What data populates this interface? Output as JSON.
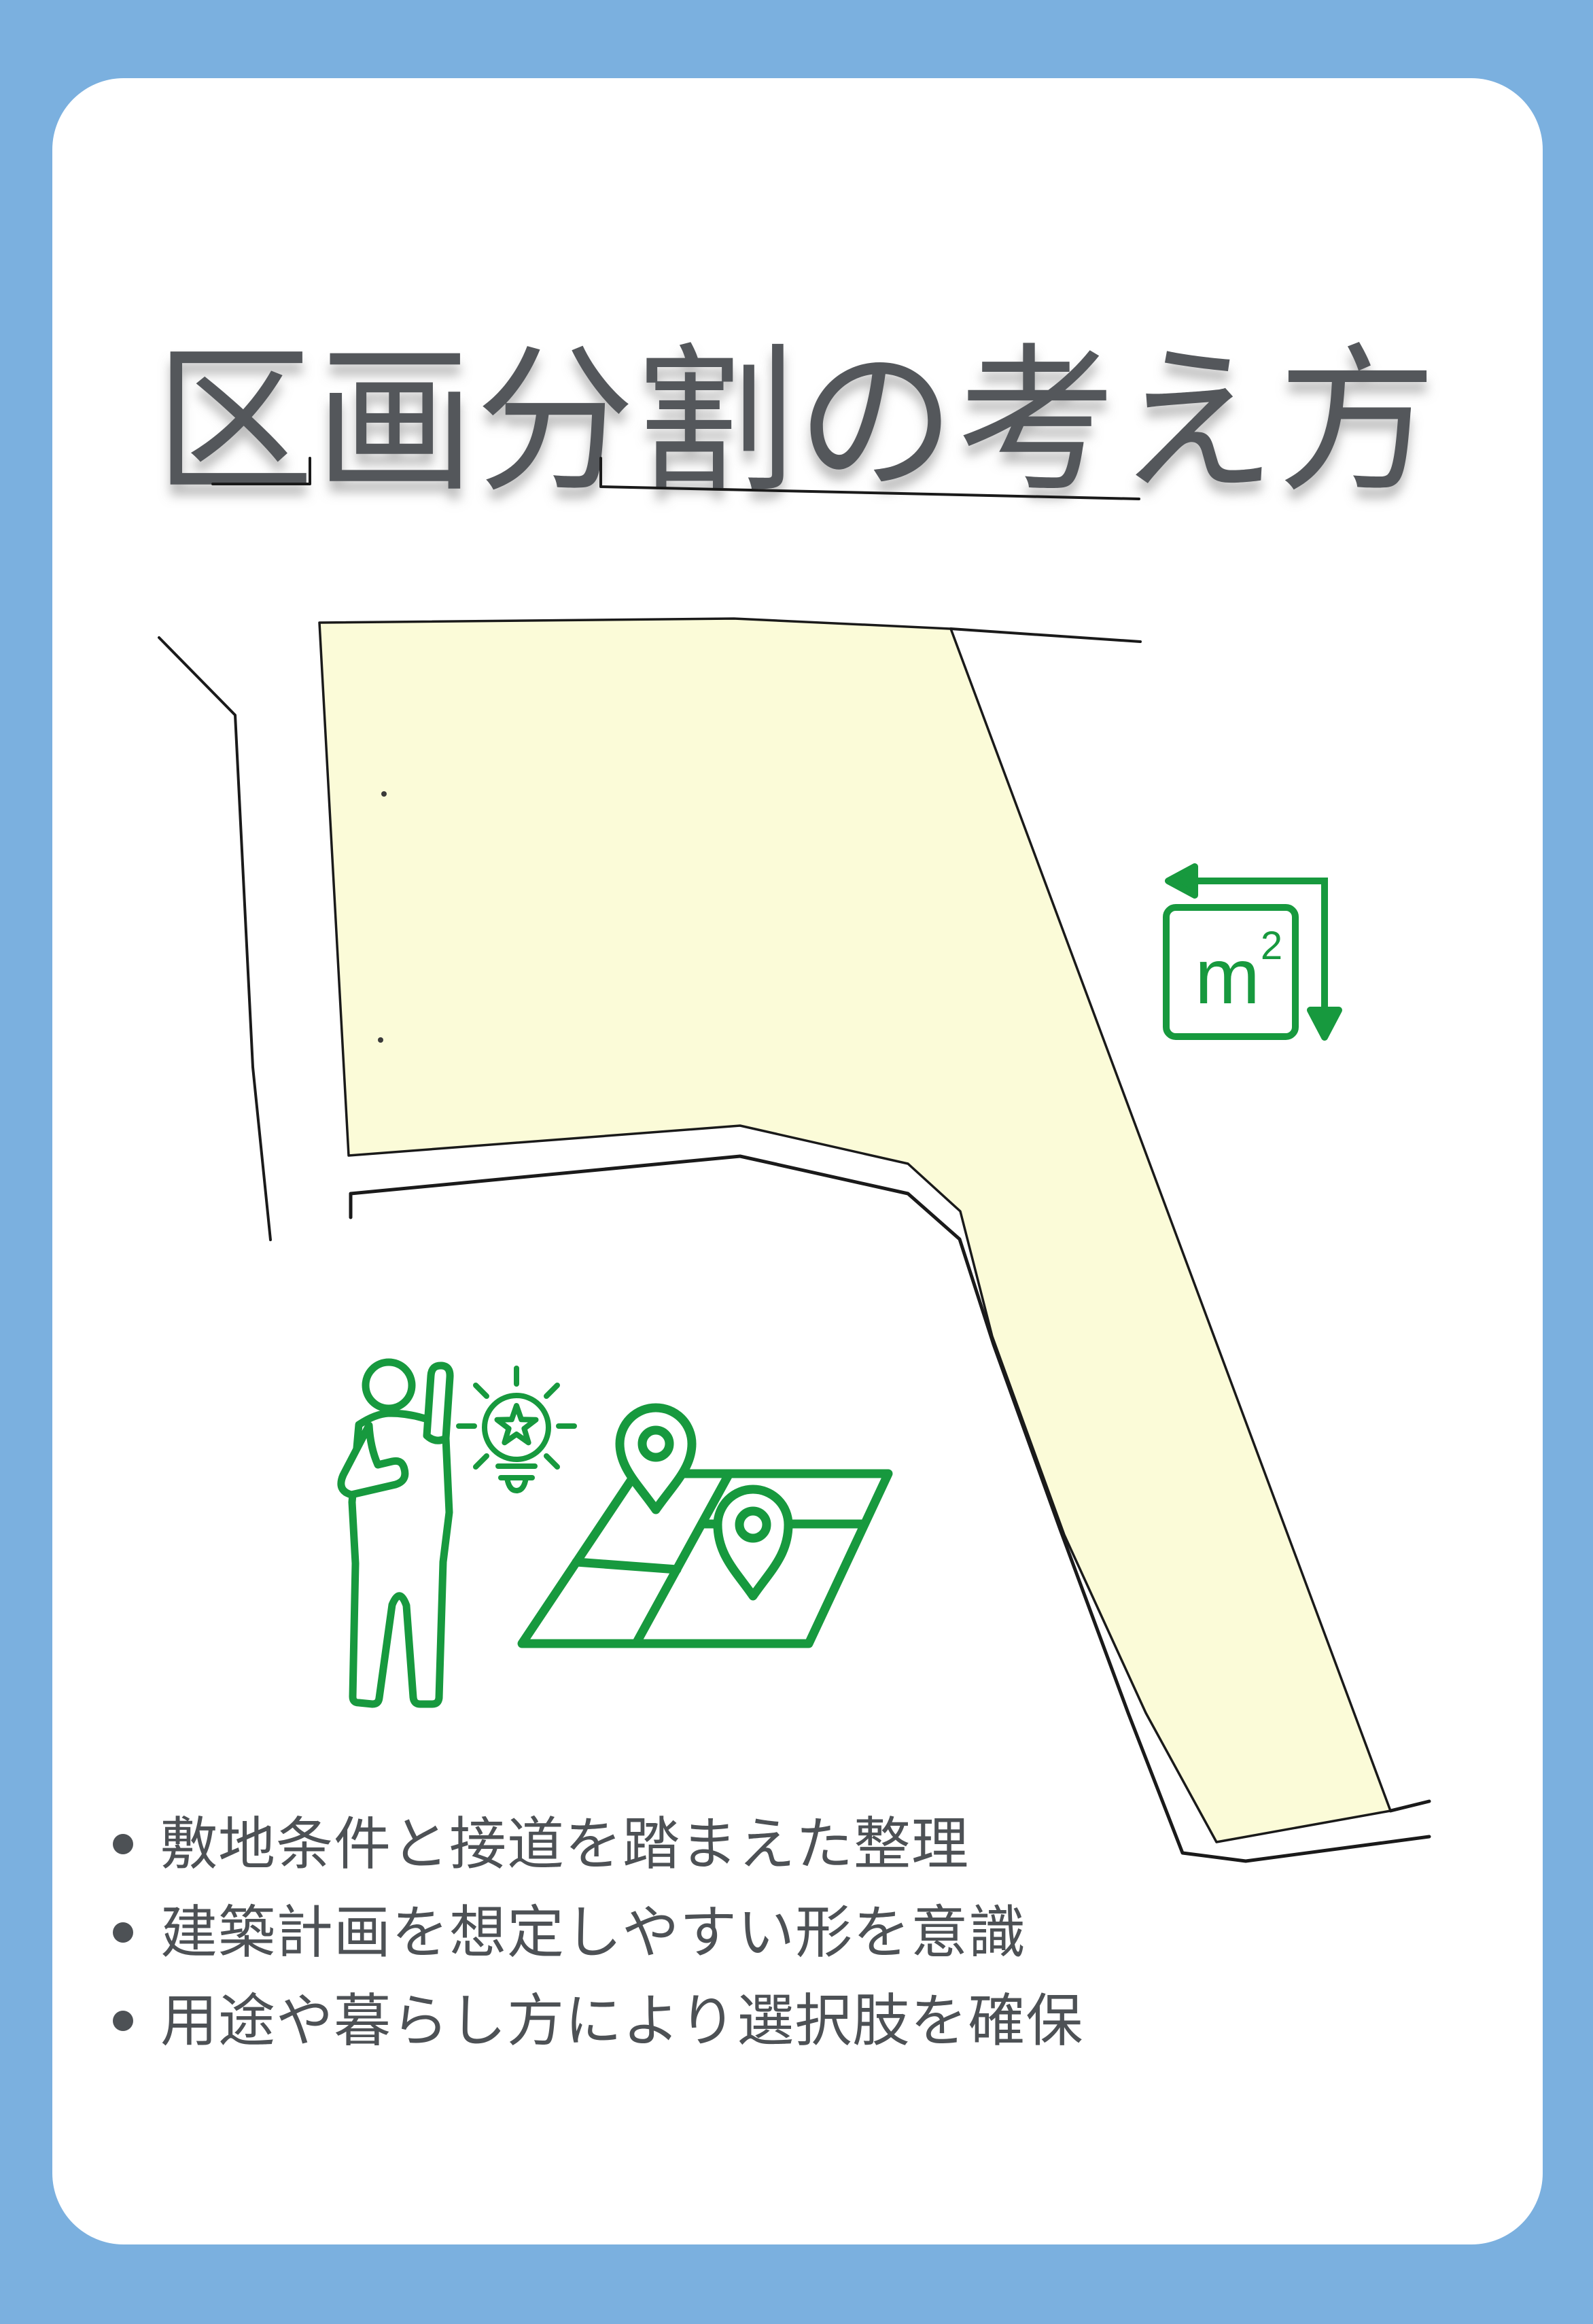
{
  "title": "区画分割の考え方",
  "bullets": [
    "敷地条件と接道を踏まえた整理",
    "建築計画を想定しやすい形を意識",
    "用途や暮らし方により選択肢を確保"
  ],
  "m2_icon": {
    "base": "m",
    "sup": "2"
  },
  "icons": [
    {
      "name": "area-measure-icon",
      "meaning": "m2 square with width/height arrows"
    },
    {
      "name": "person-presenting-icon",
      "meaning": "person raising hand"
    },
    {
      "name": "lightbulb-star-icon",
      "meaning": "idea bulb with star"
    },
    {
      "name": "map-pins-icon",
      "meaning": "folded map with two location pins"
    }
  ],
  "colors": {
    "background_blue": "#7BB0DF",
    "card_white": "#FFFFFF",
    "accent_green": "#17993E",
    "parcel_fill": "#FBFBD8",
    "line_dark": "#1A1A1A",
    "title_gray": "#54575B",
    "text_gray": "#4D5155"
  }
}
